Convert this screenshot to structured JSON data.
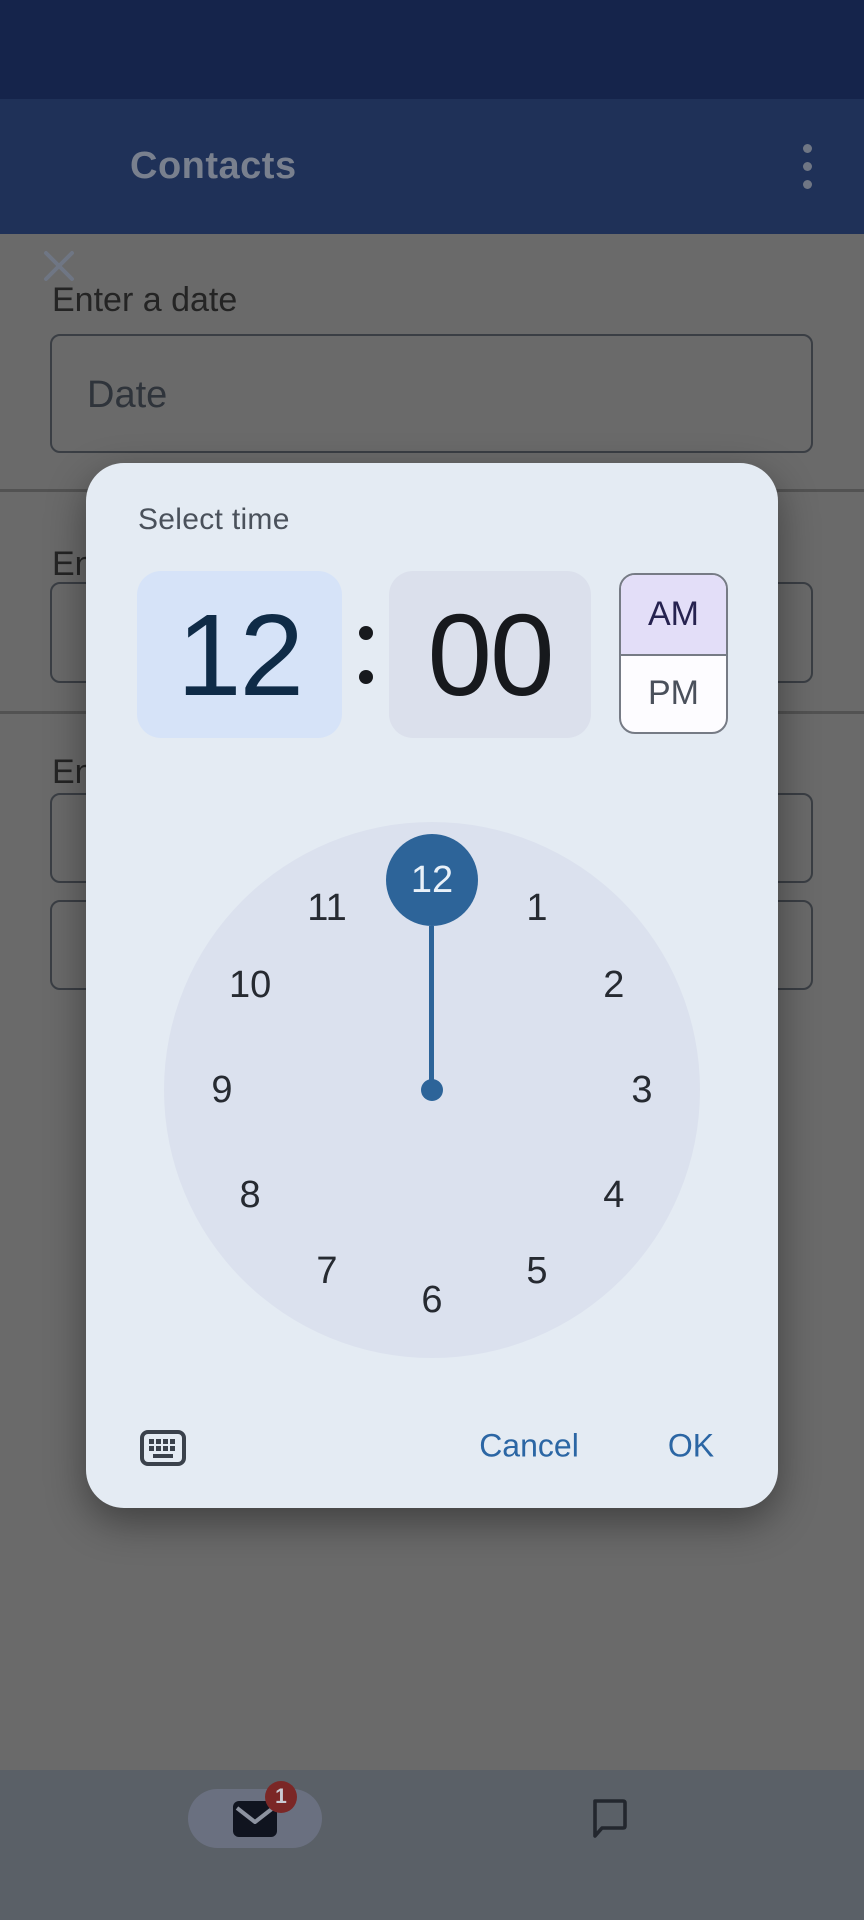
{
  "header": {
    "title": "Contacts"
  },
  "form": {
    "sections": [
      {
        "label": "Enter a date",
        "placeholder": "Date"
      },
      {
        "label": "En"
      },
      {
        "label": "En"
      }
    ]
  },
  "dialog": {
    "title": "Select time",
    "time": {
      "hour": "12",
      "minute": "00"
    },
    "meridiem": {
      "am": "AM",
      "pm": "PM",
      "selected": "AM"
    },
    "clock": {
      "numbers": [
        "12",
        "1",
        "2",
        "3",
        "4",
        "5",
        "6",
        "7",
        "8",
        "9",
        "10",
        "11"
      ],
      "selected": "12"
    },
    "actions": {
      "cancel": "Cancel",
      "ok": "OK"
    }
  },
  "nav": {
    "mail_badge": "1"
  },
  "colors": {
    "status_bar": "#15244B",
    "app_bar": "#1F3158",
    "scrim_background": "#6A6A6A",
    "dialog_background": "#E4EBF3",
    "hour_field": "#D6E3F8",
    "minute_field": "#DBE0EC",
    "am_selected": "#E3DEF8",
    "clock_face": "#DBE1EE",
    "accent_blue": "#2D6499",
    "action_text": "#2B66A4",
    "badge_red": "#7B2726",
    "nav_bar": "#5A6067"
  }
}
